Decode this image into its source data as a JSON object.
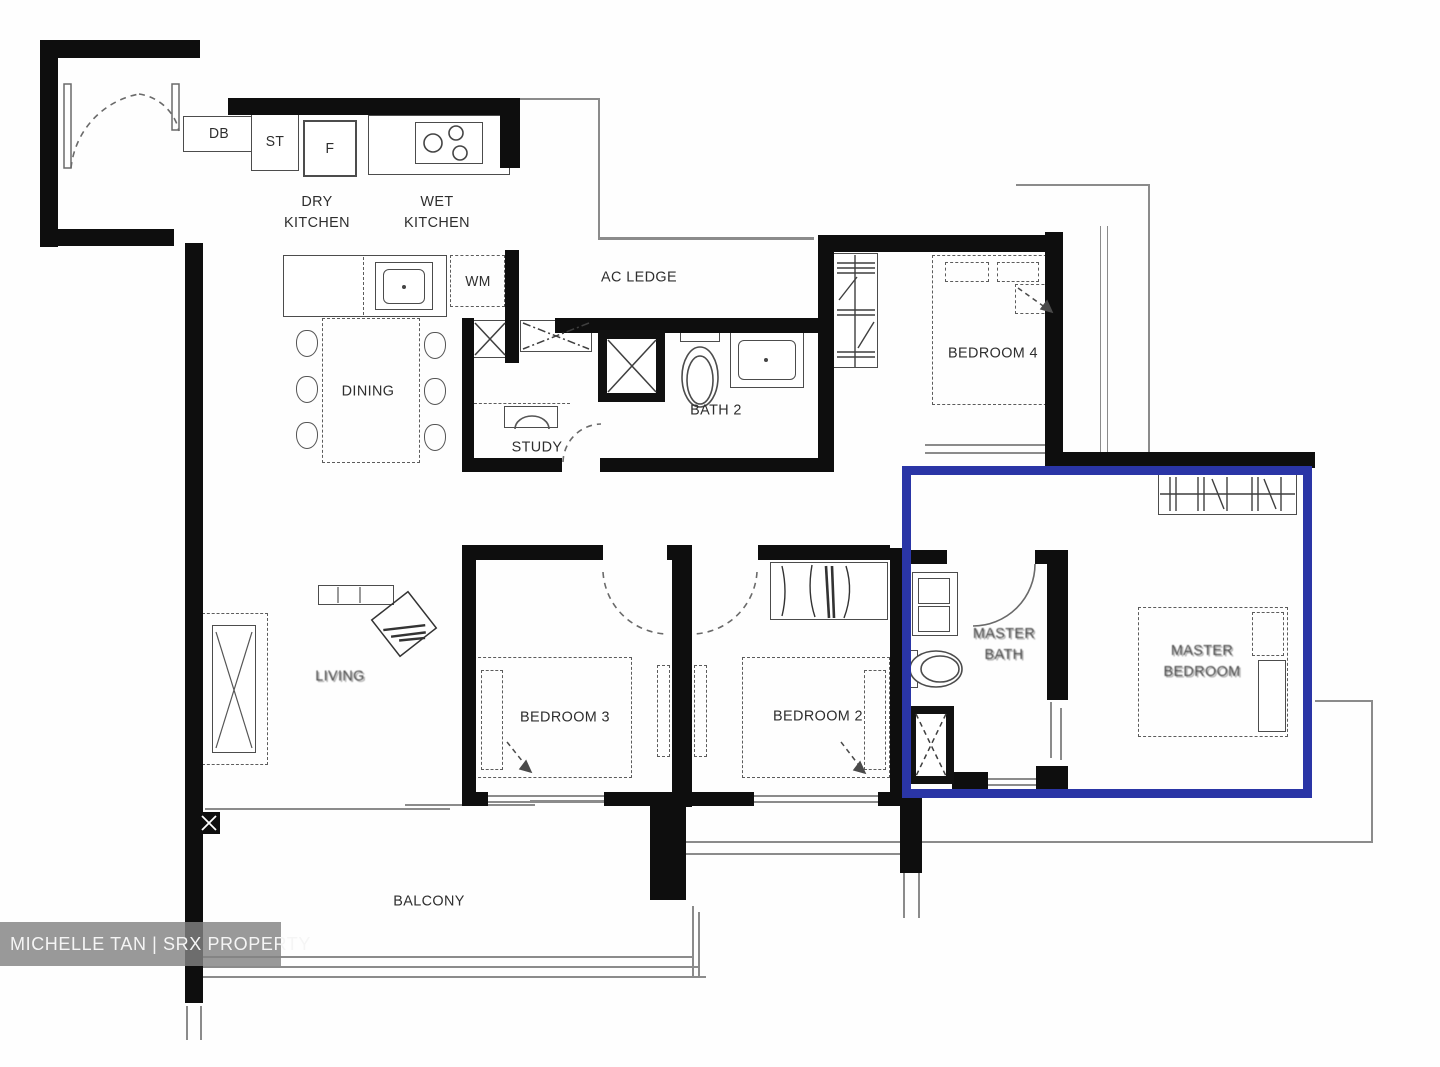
{
  "floor_plan": {
    "rooms": {
      "dry_kitchen": "DRY\nKITCHEN",
      "wet_kitchen": "WET\nKITCHEN",
      "ac_ledge": "AC LEDGE",
      "dining": "DINING",
      "study": "STUDY",
      "bath2": "BATH 2",
      "bedroom4": "BEDROOM 4",
      "bedroom3": "BEDROOM 3",
      "bedroom2": "BEDROOM 2",
      "living": "LIVING",
      "master_bath": "MASTER\nBATH",
      "master_bedroom": "MASTER\nBEDROOM",
      "balcony": "BALCONY"
    },
    "fixtures": {
      "db": "DB",
      "st": "ST",
      "fridge": "F",
      "washing_machine": "WM"
    },
    "highlight": {
      "color": "#2a35a6",
      "area": "master suite"
    },
    "watermark": {
      "text": "MICHELLE TAN | SRX PROPERTY"
    }
  }
}
